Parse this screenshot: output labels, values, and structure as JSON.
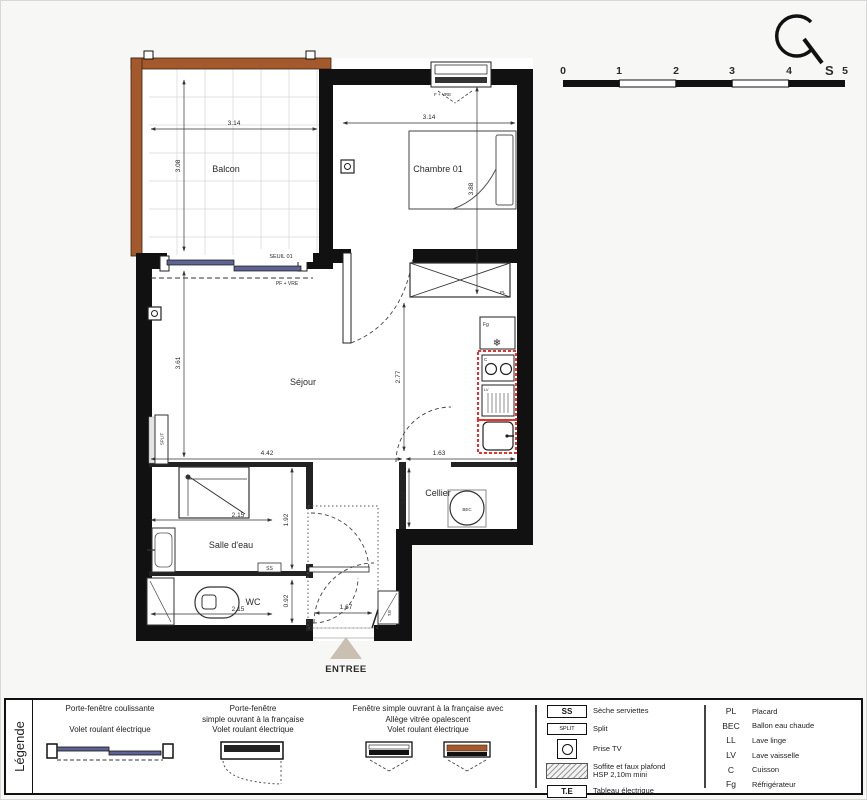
{
  "compass": {
    "south": "S"
  },
  "scale_bar": {
    "ticks": [
      "0",
      "1",
      "2",
      "3",
      "4",
      "5"
    ]
  },
  "plan": {
    "rooms": {
      "balcon": "Balcon",
      "chambre": "Chambre 01",
      "sejour": "Séjour",
      "cellier": "Cellier",
      "salle_deau": "Salle d'eau",
      "wc": "WC"
    },
    "dims": {
      "balcon_w": "3.14",
      "balcon_h": "3.08",
      "chambre_w": "3.14",
      "chambre_h": "3.88",
      "sejour_w": "4.42",
      "sejour_h": "3.61",
      "kitchen_h": "2.77",
      "cellier_w": "1.63",
      "cellier_h": "1.30",
      "sdb_w": "2.15",
      "sdb_h": "1.92",
      "wc_w": "2.15",
      "wc_h": "0.92",
      "hall_w": "1.67"
    },
    "labels": {
      "seuil": "SEUIL 01",
      "pf_vre": "PF + VRE",
      "f_vre": "F + VRE",
      "pl": "PL",
      "fg": "Fg",
      "c": "C",
      "lv": "LV",
      "bec": "BEC",
      "split": "SPLIT",
      "ss": "SS",
      "te": "T.E",
      "snowflake": "❄",
      "entree": "ENTREE"
    }
  },
  "legend": {
    "title": "Légende",
    "windows": [
      {
        "lines": [
          "Porte-fenêtre coulissante",
          "Volet roulant électrique"
        ]
      },
      {
        "lines": [
          "Porte-fenêtre",
          "simple ouvrant à la française",
          "Volet roulant électrique"
        ]
      },
      {
        "lines": [
          "Fenêtre simple ouvrant à la française avec",
          "Allège vitrée opalescent",
          "Volet roulant électrique"
        ]
      }
    ],
    "symbols": [
      {
        "key": "SS",
        "label": "Sèche serviettes"
      },
      {
        "key": "SPLIT",
        "label": "Split"
      },
      {
        "key": "prise-tv",
        "label": "Prise TV"
      },
      {
        "key": "hatch",
        "label": "Soffite et faux plafond",
        "label2": "HSP 2,10m mini"
      },
      {
        "key": "T.E",
        "label": "Tableau électrique"
      }
    ],
    "abbreviations": [
      {
        "abbr": "PL",
        "label": "Placard"
      },
      {
        "abbr": "BEC",
        "label": "Ballon eau chaude"
      },
      {
        "abbr": "LL",
        "label": "Lave linge"
      },
      {
        "abbr": "LV",
        "label": "Lave vaisselle"
      },
      {
        "abbr": "C",
        "label": "Cuisson"
      },
      {
        "abbr": "Fg",
        "label": "Réfrigérateur"
      }
    ]
  },
  "colors": {
    "wall": "#111111",
    "balcony_rail": "#a3592c",
    "door_panel": "#5d6392",
    "highlight_red": "#e8312a",
    "entry_triangle": "#c9c0b2"
  }
}
